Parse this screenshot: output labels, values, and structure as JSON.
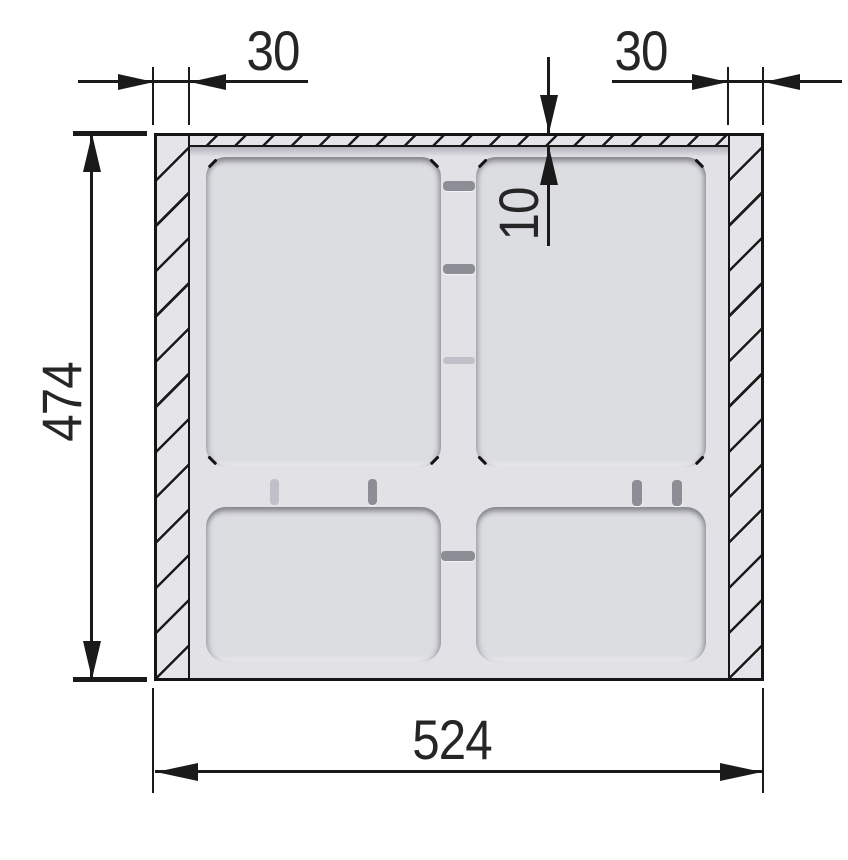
{
  "dimensions": {
    "left_wall_thickness": {
      "label": "30",
      "value": 30
    },
    "right_wall_thickness": {
      "label": "30",
      "value": 30
    },
    "top_wall_thickness": {
      "label": "10",
      "value": 10
    },
    "overall_height": {
      "label": "474",
      "value": 474
    },
    "overall_width": {
      "label": "524",
      "value": 524
    }
  },
  "colors": {
    "line": "#1a1a1a",
    "panel_fill": "#e2e2e6",
    "hatch_fill": "#e5e5e9",
    "recess_fill": "#dcdde1",
    "recess_shadow": "#85858e"
  }
}
